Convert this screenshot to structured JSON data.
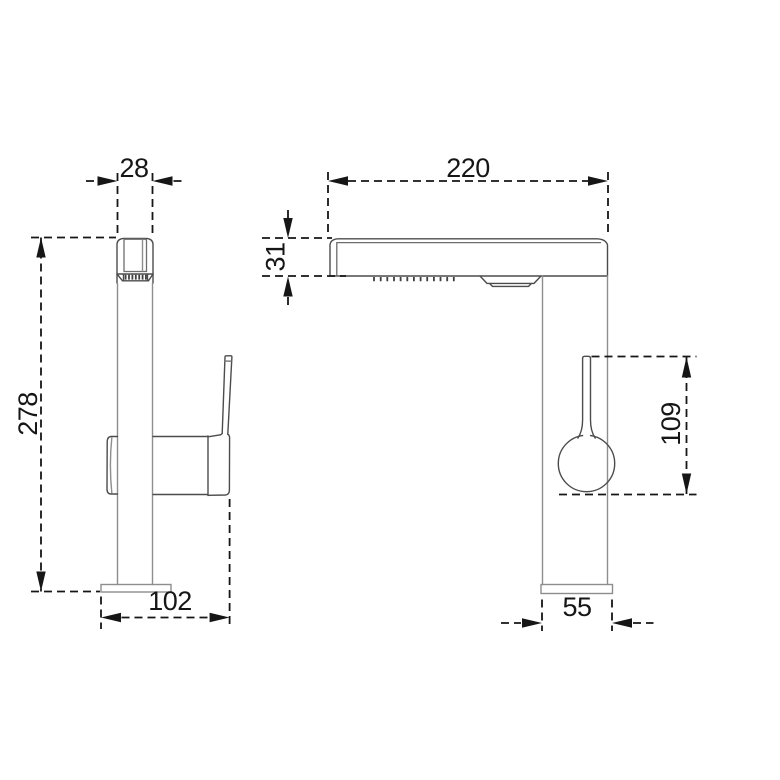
{
  "drawing": {
    "subject": "kitchen faucet two-view dimensional drawing",
    "colors": {
      "dimension_ink": "#161616",
      "outline_dark": "#4c4c4c",
      "outline_light": "#8d8d8d",
      "background": "#ffffff"
    },
    "front_view": {
      "head_width_mm": "28",
      "overall_height_mm": "278",
      "base_depth_mm": "102"
    },
    "side_view": {
      "spout_reach_mm": "220",
      "spout_body_height_mm": "31",
      "handle_length_mm": "109",
      "base_width_mm": "55"
    }
  }
}
